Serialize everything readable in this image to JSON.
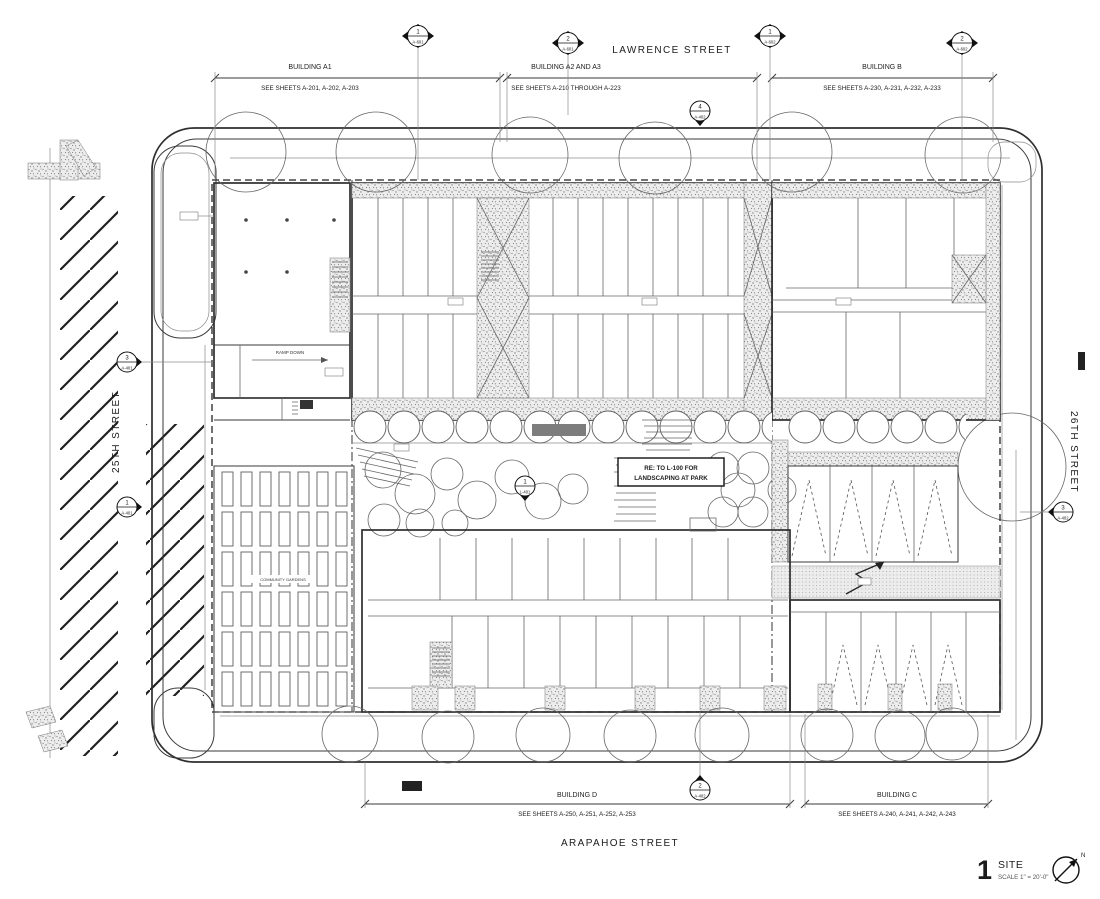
{
  "drawing": {
    "streets": {
      "top": "LAWRENCE STREET",
      "bottom": "ARAPAHOE STREET",
      "left": "25TH STREET",
      "right": "26TH STREET"
    },
    "buildings": {
      "a1": {
        "label": "BUILDING A1",
        "sheets": "SEE SHEETS A-201, A-202, A-203"
      },
      "a2a3": {
        "label": "BUILDING A2 AND A3",
        "sheets": "SEE SHEETS A-210 THROUGH A-223"
      },
      "b": {
        "label": "BUILDING B",
        "sheets": "SEE SHEETS A-230, A-231, A-232, A-233"
      },
      "d": {
        "label": "BUILDING D",
        "sheets": "SEE SHEETS A-250, A-251, A-252, A-253"
      },
      "c": {
        "label": "BUILDING C",
        "sheets": "SEE SHEETS A-240, A-241, A-242, A-243"
      }
    },
    "markers": {
      "top_1": {
        "num": "1",
        "sheet": "A-601"
      },
      "top_2": {
        "num": "2",
        "sheet": "A-601"
      },
      "top_3": {
        "num": "1",
        "sheet": "A-602"
      },
      "top_4": {
        "num": "2",
        "sheet": "A-602"
      },
      "elev_top": {
        "num": "4",
        "sheet": "A-402"
      },
      "elev_left_up": {
        "num": "3",
        "sheet": "A-401"
      },
      "elev_left_lo": {
        "num": "1",
        "sheet": "A-401"
      },
      "elev_right": {
        "num": "3",
        "sheet": "A-402"
      },
      "elev_bottom": {
        "num": "2",
        "sheet": "A-402"
      },
      "landscape": {
        "num": "1",
        "sheet": "L-401"
      }
    },
    "notes": {
      "park_line1": "RE: TO L-100 FOR",
      "park_line2": "LANDSCAPING AT PARK",
      "community_gardens": "COMMUNITY GARDENS",
      "ramp_down": "RAMP DOWN"
    },
    "titleblock": {
      "number": "1",
      "title": "SITE",
      "scale": "SCALE  1\" = 20'-0\"",
      "north_label": "N"
    }
  },
  "colors": {
    "paper": "#ffffff",
    "line": "#3a3a3a",
    "light_line": "#8b8b8b",
    "stipple_bg": "#ededed",
    "stipple_dot": "#808080",
    "hatch": "#1f1f1f"
  }
}
